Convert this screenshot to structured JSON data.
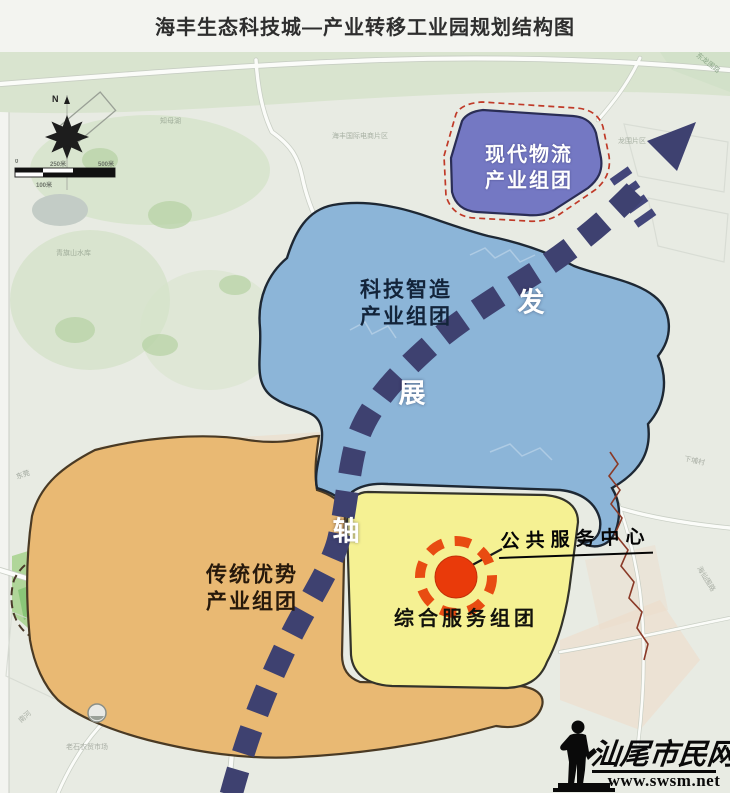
{
  "title": "海丰生态科技城—产业转移工业园规划结构图",
  "compass": {
    "north_label": "N"
  },
  "scale_bar": {
    "ticks": [
      "0",
      "250米",
      "500米",
      "100米"
    ]
  },
  "zones": {
    "logistics": {
      "label_line1": "现代物流",
      "label_line2": "产业组团",
      "color": "#7478c3"
    },
    "tech": {
      "label_line1": "科技智造",
      "label_line2": "产业组团",
      "color": "#8cb5d8"
    },
    "traditional": {
      "label_line1": "传统优势",
      "label_line2": "产业组团",
      "color": "#e9b973"
    },
    "service": {
      "label": "综合服务组团",
      "color": "#f5f193"
    }
  },
  "poi": {
    "label": "公共服务中心",
    "marker_color": "#e93a0a",
    "ring_color": "#e84c12"
  },
  "axis": {
    "name": "发展轴",
    "color": "#3e4170",
    "chars": [
      {
        "char": "发",
        "x": 531,
        "y": 300
      },
      {
        "char": "展",
        "x": 412,
        "y": 391
      },
      {
        "char": "轴",
        "x": 346,
        "y": 529
      }
    ]
  },
  "boundary": {
    "park_dash_color": "#4a3a2a",
    "red_dash_color": "#c03a28"
  },
  "watermark": {
    "site_name": "汕尾市民网",
    "url": "www.swsm.net"
  },
  "faint_labels": [
    {
      "text": "东莞",
      "x": 16,
      "y": 470,
      "rot": -18,
      "color": "#8a9288"
    },
    {
      "text": "青旗山水库",
      "x": 56,
      "y": 248,
      "rot": 0,
      "color": "#93a08e"
    },
    {
      "text": "知母湖",
      "x": 160,
      "y": 116,
      "rot": 0,
      "color": "#93a08e"
    },
    {
      "text": "海丰国际电商片区",
      "x": 332,
      "y": 131,
      "rot": 0,
      "color": "#98a294"
    },
    {
      "text": "龙围片区",
      "x": 618,
      "y": 136,
      "rot": 0,
      "color": "#98a294"
    },
    {
      "text": "东龙围路",
      "x": 694,
      "y": 58,
      "rot": 38,
      "color": "#7a9a78"
    },
    {
      "text": "下埔村",
      "x": 684,
      "y": 456,
      "rot": 12,
      "color": "#9aa096"
    },
    {
      "text": "海仙围路",
      "x": 692,
      "y": 574,
      "rot": 58,
      "color": "#9aa096"
    },
    {
      "text": "南河",
      "x": 18,
      "y": 712,
      "rot": -42,
      "color": "#9aa096"
    },
    {
      "text": "老石农贸市场",
      "x": 66,
      "y": 742,
      "rot": 0,
      "color": "#9aa096"
    }
  ]
}
